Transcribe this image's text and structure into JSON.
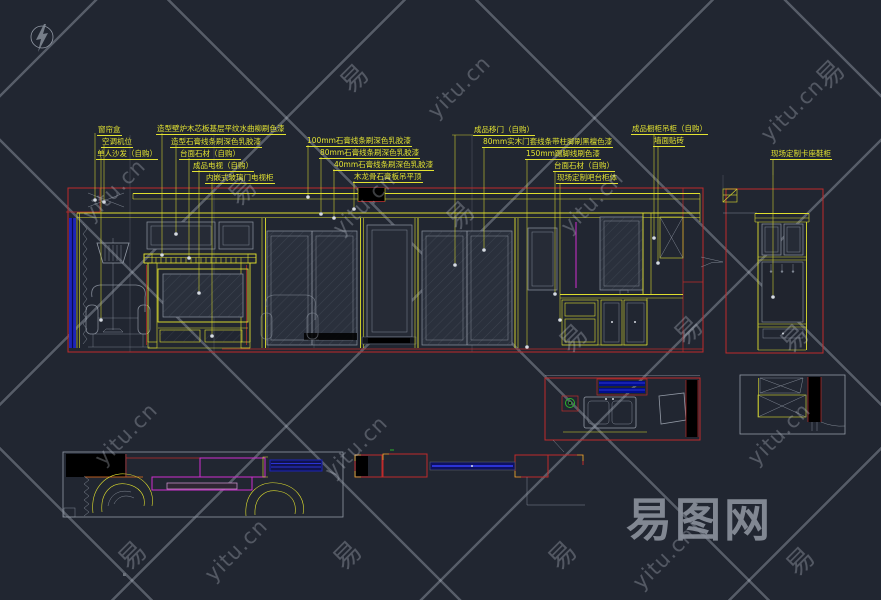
{
  "page": {
    "width": 881,
    "height": 600,
    "background": "#212631"
  },
  "colors": {
    "line_yellow": "#dede2e",
    "line_red": "#bf2b2b",
    "line_magenta": "#cf2fcf",
    "line_blue": "#2b33d6",
    "line_gray": "#939aa6",
    "line_green": "#2bb32b",
    "fill_black": "#000000",
    "watermark_gray": "#8a909b",
    "background": "#212631"
  },
  "annotations": {
    "left": [
      "窗帘盒",
      "空调机位",
      "单人沙发（自购）",
      "造型壁炉木芯板基层平纹水曲柳刷色漆",
      "造型石膏线条刷深色乳胶漆",
      "台面石材（自购）",
      "成品电视（自购）",
      "内嵌式玻璃门电视柜"
    ],
    "middle": [
      "100mm石膏线条刷深色乳胶漆",
      "80mm石膏线条刷深色乳胶漆",
      "40mm石膏线条刷深色乳胶漆",
      "木龙骨石膏板吊平顶"
    ],
    "right": [
      "成品移门（自购）",
      "80mm实木门套线条带柱脚刷黑檀色漆",
      "150mm踢脚线刷色漆",
      "台面石材（自购）",
      "现场定制吧台柜体"
    ],
    "cabinet": [
      "成品橱柜吊柜（自购）",
      "墙面贴砖"
    ],
    "entry": [
      "现场定制卡座鞋柜"
    ]
  },
  "watermark": {
    "site_name_large": "易图网",
    "site_url": "yitu.cn",
    "tile_char": "易"
  }
}
